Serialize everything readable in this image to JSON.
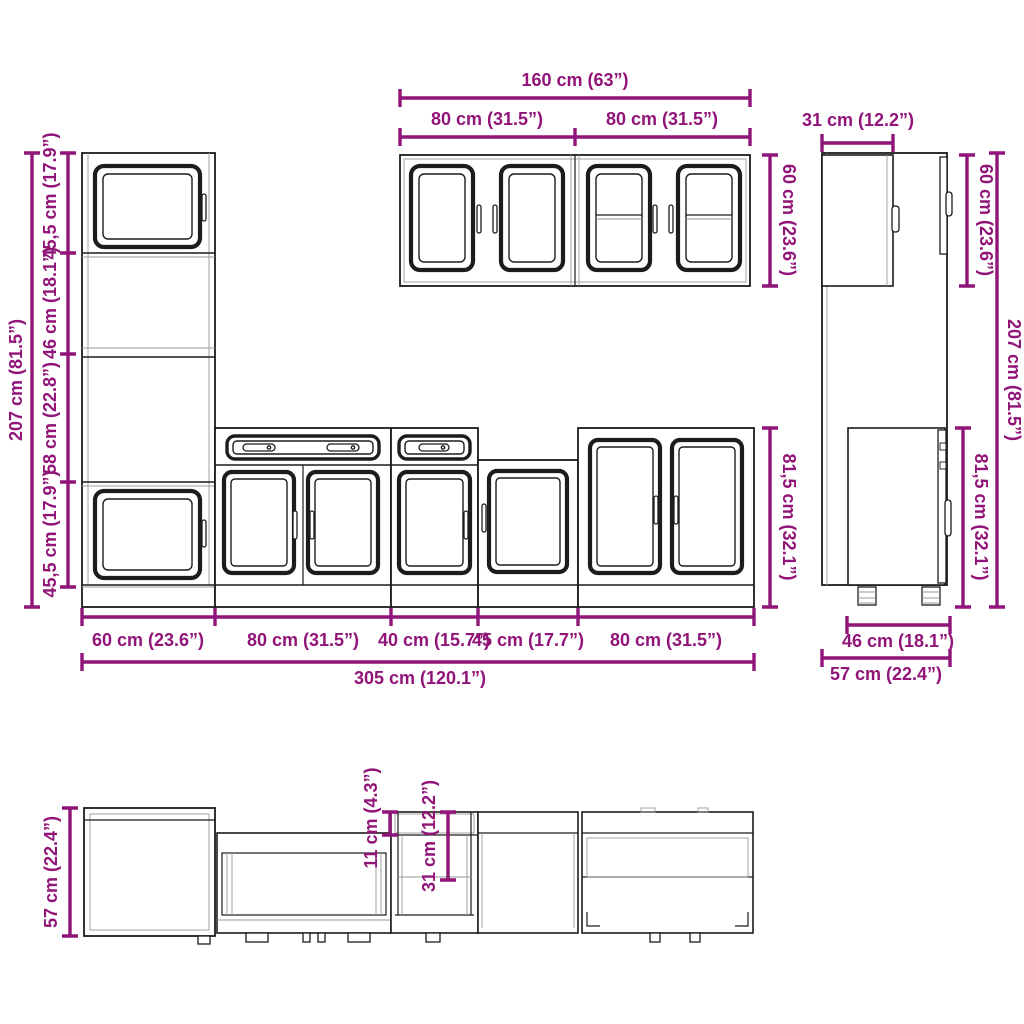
{
  "diagram": {
    "type": "kitchen-cabinet-set-dimension-drawing",
    "colors": {
      "dimension": "#911478",
      "outline": "#1c1c1c",
      "light_line": "#9a9a9a",
      "background": "#ffffff"
    },
    "front_view": {
      "height_total": "207 cm (81.5”)",
      "height_segments": [
        "45,5 cm (17.9”)",
        "46 cm (18.1”)",
        "58 cm (22.8”)",
        "45,5 cm (17.9”)"
      ],
      "base_height": "81,5 cm (32.1”)",
      "widths": [
        "60 cm (23.6”)",
        "80 cm (31.5”)",
        "40 cm (15.7”)",
        "45 cm (17.7”)",
        "80 cm (31.5”)"
      ],
      "width_total": "305 cm (120.1”)"
    },
    "wall_cabinets": {
      "width_total": "160 cm (63”)",
      "width_left": "80 cm (31.5”)",
      "width_right": "80 cm (31.5”)",
      "height": "60 cm (23.6”)"
    },
    "side_view": {
      "wall_depth": "31 cm (12.2”)",
      "wall_height": "60 cm (23.6”)",
      "height_total": "207 cm (81.5”)",
      "base_height": "81,5 cm (32.1”)",
      "base_depth": "46 cm (18.1”)",
      "depth_total": "57 cm (22.4”)"
    },
    "plan_view": {
      "depth_total": "57 cm (22.4”)",
      "worktop_overhang": "11 cm (4.3”)",
      "upper_depth": "31 cm (12.2”)"
    }
  }
}
